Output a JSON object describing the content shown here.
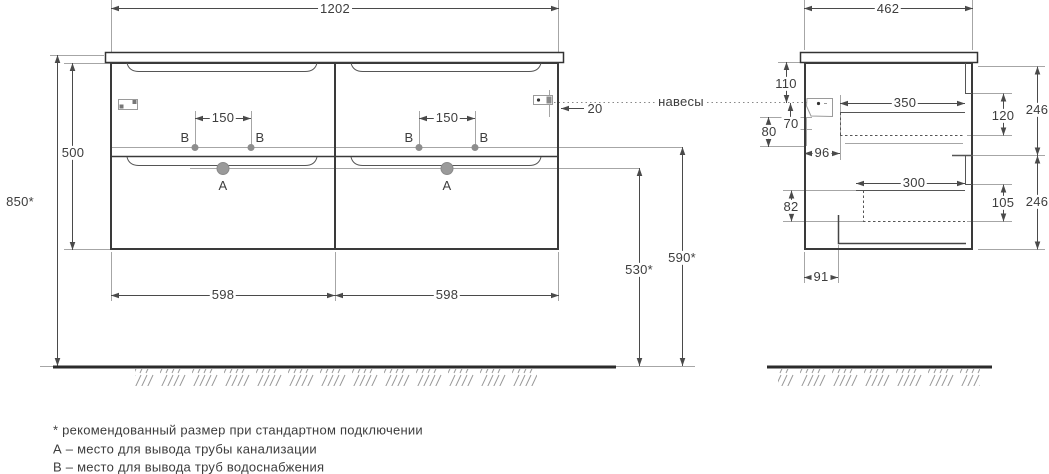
{
  "front": {
    "dim_width": "1202",
    "dim_height": "500",
    "dim_total_height": "850*",
    "dim_spacing_b": "150",
    "dim_offset_hangers": "20",
    "dim_half_width": "598",
    "dim_drain_height": "530*",
    "dim_supply_height": "590*",
    "label_drain": "А",
    "label_supply": "В"
  },
  "side": {
    "dim_depth": "462",
    "dim_110": "110",
    "dim_80": "80",
    "dim_70": "70",
    "dim_96": "96",
    "dim_350": "350",
    "dim_120": "120",
    "dim_246_upper": "246",
    "dim_300": "300",
    "dim_82": "82",
    "dim_105": "105",
    "dim_246_lower": "246",
    "dim_91": "91"
  },
  "annotations": {
    "hangers": "навесы"
  },
  "footnotes": {
    "recommended": "* рекомендованный размер при стандартном подключении",
    "drain": "А – место для вывода трубы канализации",
    "supply": "В – место для вывода труб водоснабжения"
  },
  "colors": {
    "line": "#3a3a3a",
    "thin_line": "#a6a6a6",
    "dim_line": "#4a4a4a",
    "text": "#3d3d3d"
  }
}
